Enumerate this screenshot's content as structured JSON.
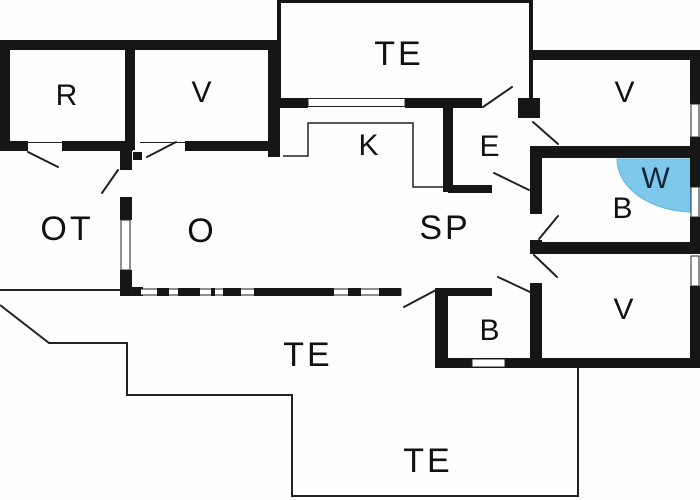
{
  "title": "Holiday home floor plan",
  "colors": {
    "wall": "#161616",
    "line": "#222222",
    "water": "#7ec8eb",
    "water_edge": "#62b5de",
    "background": "#fefefe",
    "label": "#111111",
    "wet_label": "#13233a"
  },
  "rooms": {
    "r": {
      "label": "R"
    },
    "v_top_left": {
      "label": "V"
    },
    "te_top": {
      "label": "TE"
    },
    "v_top_right": {
      "label": "V"
    },
    "k": {
      "label": "K"
    },
    "e": {
      "label": "E"
    },
    "w": {
      "label": "W"
    },
    "b_right": {
      "label": "B"
    },
    "ot": {
      "label": "OT"
    },
    "o": {
      "label": "O"
    },
    "sp": {
      "label": "SP"
    },
    "v_bottom_right": {
      "label": "V"
    },
    "b_bottom": {
      "label": "B"
    },
    "te_middle": {
      "label": "TE"
    },
    "te_bottom": {
      "label": "TE"
    }
  }
}
